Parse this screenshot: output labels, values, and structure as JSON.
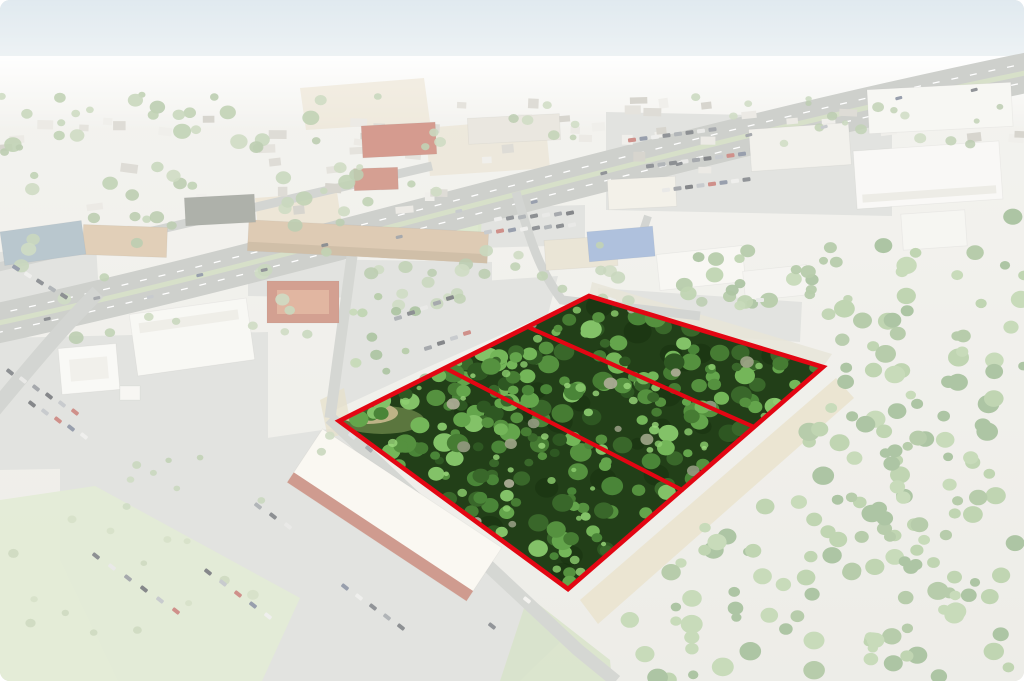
{
  "meta": {
    "description": "Aerial drone photograph of a wooded land parcel outlined in red and divided into three lots, shown in full color while the surrounding retail corridor, highway, parking lots and forest are faded white",
    "width": 1024,
    "height": 681
  },
  "parcel": {
    "outline_points": "339,421 589,296 823,367 568,589",
    "divider_lines": [
      [
        528,
        327,
        754,
        427
      ],
      [
        445,
        368,
        682,
        490
      ]
    ],
    "lots_count": 3,
    "stroke_color": "#e30613",
    "stroke_width": 4.6,
    "divider_width": 4.2,
    "base_fill": "#223f18",
    "sand_patch": {
      "cx": 368,
      "cy": 413,
      "rx": 30,
      "ry": 11,
      "fill": "#c9ba8e"
    },
    "grass_patch": {
      "cx": 382,
      "cy": 420,
      "rx": 42,
      "ry": 14,
      "fill": "#8aa45f",
      "opacity": 0.55
    },
    "shadows": {
      "count": 24,
      "rmin": 6,
      "rmax": 14,
      "colors": [
        "#142c0d"
      ],
      "opacity": 0.4
    },
    "trees": {
      "count": 235,
      "rmin": 4.5,
      "rmax": 11,
      "colors": [
        "#39672a",
        "#467c33",
        "#55913f",
        "#64a54c",
        "#74b659",
        "#83c268",
        "#2e5722",
        "#4a8538"
      ],
      "opacity": 1
    },
    "highlights": {
      "count": 40,
      "rmin": 2.5,
      "rmax": 5,
      "colors": [
        "#8ecf70",
        "#9bd87c"
      ],
      "opacity": 0.8
    },
    "dead_trees": {
      "count": 16,
      "rmin": 3.5,
      "rmax": 7,
      "colors": [
        "#9aa184",
        "#abab93",
        "#8f977c"
      ],
      "opacity": 0.95
    }
  },
  "scene": {
    "sky": {
      "top": "#c7d8e2",
      "bottom": "#eef2f3",
      "height": 95
    },
    "ground": {
      "top": "#eae9e2",
      "bottom": "#dfded5"
    },
    "haze": {
      "y": 56,
      "h": 74
    },
    "wash": {
      "color": "#ffffff",
      "opacity": 0.45
    },
    "lot_fill": "#cbcdc6",
    "lots": [
      "0,338 268,332 268,465 0,470",
      "0,252 96,244 100,312 0,318",
      "344,290 558,276 548,314 426,368 326,414",
      "606,112 892,118 892,216 606,210",
      "478,208 585,205 585,245 478,248",
      "60,468 336,428 560,642 520,681 118,681 60,560",
      "248,258 492,262 492,300 248,296",
      "598,288 802,302 800,342 596,328"
    ],
    "patches": [
      {
        "points": "255,198 337,192 342,226 258,230",
        "fill": "#d8c49c",
        "opacity": 0.6
      },
      {
        "points": "300,88 424,78 430,122 306,130",
        "fill": "#d9c8a2",
        "opacity": 0.5
      },
      {
        "points": "425,128 545,118 550,168 430,176",
        "fill": "#d6c6a0",
        "opacity": 0.5
      },
      {
        "points": "836,378 854,398 598,624 580,600",
        "fill": "#d8cda6",
        "opacity": 0.85
      },
      {
        "points": "592,282 832,354 823,367 589,296",
        "fill": "#d5d0b8",
        "opacity": 0.8
      },
      {
        "points": "320,400 344,388 352,432 328,438",
        "fill": "#d2c69e",
        "opacity": 0.7
      },
      {
        "points": "0,500 95,486 300,598 262,681 0,681",
        "fill": "#ccdbb4",
        "opacity": 0.9
      },
      {
        "points": "528,596 610,660 612,681 500,681",
        "fill": "#b9cc9e",
        "opacity": 0.85
      },
      {
        "points": "438,215 482,210 480,258 440,260",
        "fill": "#b9d29a",
        "opacity": 0.8
      }
    ],
    "roads": [
      {
        "d": "M -6,324 C 300,258 650,150 1030,72",
        "w": 40,
        "c": "#a6a9a3"
      },
      {
        "d": "M -6,324 C 300,258 650,150 1030,72",
        "w": 5,
        "c": "#b7c79d"
      },
      {
        "d": "M -4,333 C 302,267 652,159 1032,81",
        "w": 1.3,
        "c": "#ffffff",
        "dash": "7 12"
      },
      {
        "d": "M -8,315 C 298,249 648,141 1028,63",
        "w": 1.3,
        "c": "#ffffff",
        "dash": "7 12"
      },
      {
        "d": "M -6,268 C 150,232 300,198 432,166",
        "w": 9,
        "c": "#b0b3ad"
      },
      {
        "d": "M 98,292 C 60,330 24,374 -6,410",
        "w": 15,
        "c": "#b0b3ad"
      },
      {
        "d": "M 352,256 L 330,418",
        "w": 11,
        "c": "#b3b6b0"
      },
      {
        "d": "M 330,418 L 578,650 L 616,681",
        "w": 13,
        "c": "#b3b6b0"
      },
      {
        "d": "M 516,192 C 530,240 540,272 562,300 L 700,316",
        "w": 9,
        "c": "#b0b3ad"
      },
      {
        "d": "M 648,216 L 636,252",
        "w": 8,
        "c": "#b0b3ad"
      }
    ],
    "buildings": [
      [
        83,
        226,
        84,
        30,
        2,
        "#c8a87e",
        null
      ],
      [
        248,
        226,
        240,
        31,
        3,
        "#c4a077",
        [
          0,
          22,
          240,
          9,
          "#a98a62"
        ]
      ],
      [
        362,
        124,
        74,
        32,
        -3,
        "#b24a33",
        null
      ],
      [
        354,
        168,
        44,
        22,
        -2,
        "#b2503a",
        null
      ],
      [
        468,
        116,
        92,
        26,
        -3,
        "#d9d4c6",
        null
      ],
      [
        185,
        196,
        70,
        28,
        -3,
        "#6c7164",
        null
      ],
      [
        2,
        226,
        82,
        34,
        -8,
        "#8099a7",
        null
      ],
      [
        267,
        281,
        72,
        42,
        0,
        "#b05238",
        [
          10,
          9,
          52,
          24,
          "#c97a55"
        ]
      ],
      [
        133,
        306,
        118,
        62,
        -8,
        "#f3f2ec",
        [
          8,
          10,
          100,
          10,
          "#e2e0d6"
        ]
      ],
      [
        60,
        346,
        58,
        46,
        -5,
        "#f5f4ef",
        [
          10,
          12,
          38,
          22,
          "#e6e3da"
        ]
      ],
      [
        120,
        386,
        20,
        14,
        0,
        "#f0efe9",
        null
      ],
      [
        545,
        238,
        72,
        30,
        -4,
        "#d9cfb4",
        null
      ],
      [
        588,
        229,
        66,
        30,
        -5,
        "#6e8fc2",
        null
      ],
      [
        608,
        178,
        68,
        30,
        -3,
        "#e9e5d8",
        null
      ],
      [
        658,
        250,
        86,
        36,
        -6,
        "#f2f1ea",
        null
      ],
      [
        744,
        268,
        64,
        30,
        -6,
        "#edece5",
        null
      ],
      [
        855,
        146,
        146,
        58,
        -4,
        "#f4f3ee",
        [
          6,
          44,
          134,
          8,
          "#dedcd2"
        ]
      ],
      [
        868,
        86,
        144,
        44,
        -3,
        "#f1f0e9",
        null
      ],
      [
        750,
        126,
        100,
        42,
        -4,
        "#e8e6dd",
        null
      ],
      [
        902,
        212,
        64,
        36,
        -4,
        "#efeee8",
        null
      ],
      [
        287,
        483,
        215,
        64,
        33.5,
        "#f6f2e7",
        [
          0,
          52,
          215,
          12,
          "#a84a33"
        ]
      ]
    ],
    "house_colors": [
      "#dcd9d0",
      "#cfccc2",
      "#c4c0b4",
      "#e4e2da",
      "#b7b3a7"
    ],
    "house_regions": [
      {
        "poly": "0,98 465,98 465,220 0,220",
        "count": 32
      },
      {
        "poly": "462,112 740,96 748,168 470,184",
        "count": 13
      },
      {
        "poly": "480,100 1024,100 1024,140 480,140",
        "count": 20
      }
    ],
    "tree_regions": [
      {
        "poly": "0,92 470,92 470,228 0,228",
        "count": 60,
        "rmin": 3.5,
        "rmax": 9,
        "colors": [
          "#9db88a",
          "#8fae79",
          "#a8c094",
          "#86a572"
        ],
        "opacity": 0.9
      },
      {
        "poly": "470,96 1024,96 1024,148 470,148",
        "count": 24,
        "rmin": 3,
        "rmax": 6.5,
        "colors": [
          "#9db88a",
          "#8fae79",
          "#a8c094",
          "#86a572"
        ],
        "opacity": 0.85
      },
      {
        "poly": "0,228 360,228 360,345 0,345",
        "count": 18,
        "rmin": 4,
        "rmax": 8,
        "colors": [
          "#9db88a",
          "#8fae79",
          "#a8c094",
          "#86a572"
        ],
        "opacity": 0.9
      },
      {
        "poly": "360,252 700,240 704,308 365,305",
        "count": 26,
        "rmin": 4,
        "rmax": 7.5,
        "colors": [
          "#9db88a",
          "#8fae79",
          "#a8c094",
          "#86a572"
        ],
        "opacity": 0.9
      },
      {
        "poly": "352,298 420,292 432,425 348,418",
        "count": 14,
        "rmin": 3.5,
        "rmax": 6.5,
        "colors": [
          "#7ca366",
          "#8db274",
          "#6b965a",
          "#9bbd82"
        ],
        "opacity": 0.95
      },
      {
        "poly": "610,255 850,235 858,352 700,300",
        "count": 26,
        "rmin": 4.5,
        "rmax": 9,
        "colors": [
          "#7ca366",
          "#8db274",
          "#6b965a",
          "#9bbd82"
        ],
        "opacity": 0.95
      },
      {
        "poly": "840,252 1024,214 1024,681 642,681 592,622 846,392",
        "count": 170,
        "rmin": 5,
        "rmax": 11,
        "colors": [
          "#7ca366",
          "#8db274",
          "#6b965a",
          "#9bbd82"
        ],
        "opacity": 1
      },
      {
        "poly": "0,505 95,490 298,598 262,681 0,681",
        "count": 14,
        "rmin": 3,
        "rmax": 6,
        "colors": [
          "#a9bd8e",
          "#b7c99b"
        ],
        "opacity": 0.9
      },
      {
        "poly": "60,470 330,432 380,470 120,560",
        "count": 10,
        "rmin": 2.5,
        "rmax": 5,
        "colors": [
          "#9db88a",
          "#8fae79",
          "#a8c094"
        ],
        "opacity": 0.9
      }
    ],
    "car_colors": [
      "#30353b",
      "#d7d8d4",
      "#5d636a",
      "#22262b",
      "#9ba1a7",
      "#a8352a",
      "#44516b",
      "#e2e2de",
      "#383d44",
      "#71787f"
    ],
    "car_rows": [
      [
        10,
        372,
        13,
        8,
        6,
        38
      ],
      [
        32,
        404,
        13,
        8,
        5,
        38
      ],
      [
        16,
        268,
        12,
        7,
        5,
        33
      ],
      [
        398,
        318,
        13,
        -5,
        5,
        -17
      ],
      [
        428,
        348,
        13,
        -5,
        4,
        -17
      ],
      [
        632,
        140,
        11.5,
        -1.5,
        8,
        -8
      ],
      [
        650,
        166,
        11.5,
        -1.5,
        9,
        -8
      ],
      [
        666,
        190,
        11.5,
        -1.5,
        8,
        -8
      ],
      [
        488,
        232,
        12,
        -1,
        8,
        -12
      ],
      [
        498,
        219,
        12,
        -1,
        7,
        -12
      ],
      [
        96,
        556,
        16,
        11,
        6,
        38
      ],
      [
        208,
        572,
        15,
        11,
        5,
        38
      ],
      [
        345,
        587,
        14,
        10,
        5,
        38
      ],
      [
        258,
        506,
        15,
        10,
        3,
        38
      ]
    ],
    "single_cars": [
      [
        452,
        497,
        40,
        "#f2f2ee"
      ],
      [
        468,
        512,
        40,
        "#9aa0a5"
      ],
      [
        431,
        478,
        40,
        "#2f343a"
      ],
      [
        527,
        600,
        38,
        "#eceae4"
      ],
      [
        492,
        626,
        38,
        "#3a3f45"
      ],
      [
        352,
        436,
        40,
        "#c9ced2"
      ],
      [
        369,
        449,
        40,
        "#666c73"
      ],
      [
        612,
        300,
        20,
        "#dfe0dc"
      ],
      [
        629,
        309,
        20,
        "#41474e"
      ],
      [
        760,
        300,
        0,
        "#d8d9d5"
      ]
    ],
    "highway_cars": [
      [
        46,
        314,
        1
      ],
      [
        98,
        303,
        -1
      ],
      [
        149,
        292,
        1
      ],
      [
        201,
        280,
        -1
      ],
      [
        263,
        265,
        1
      ],
      [
        326,
        250,
        -1
      ],
      [
        398,
        232,
        1
      ],
      [
        460,
        216,
        -1
      ],
      [
        533,
        197,
        1
      ],
      [
        605,
        178,
        -1
      ],
      [
        678,
        159,
        1
      ],
      [
        750,
        140,
        -1
      ],
      [
        823,
        122,
        1
      ],
      [
        900,
        103,
        -1
      ],
      [
        973,
        85,
        1
      ]
    ]
  }
}
